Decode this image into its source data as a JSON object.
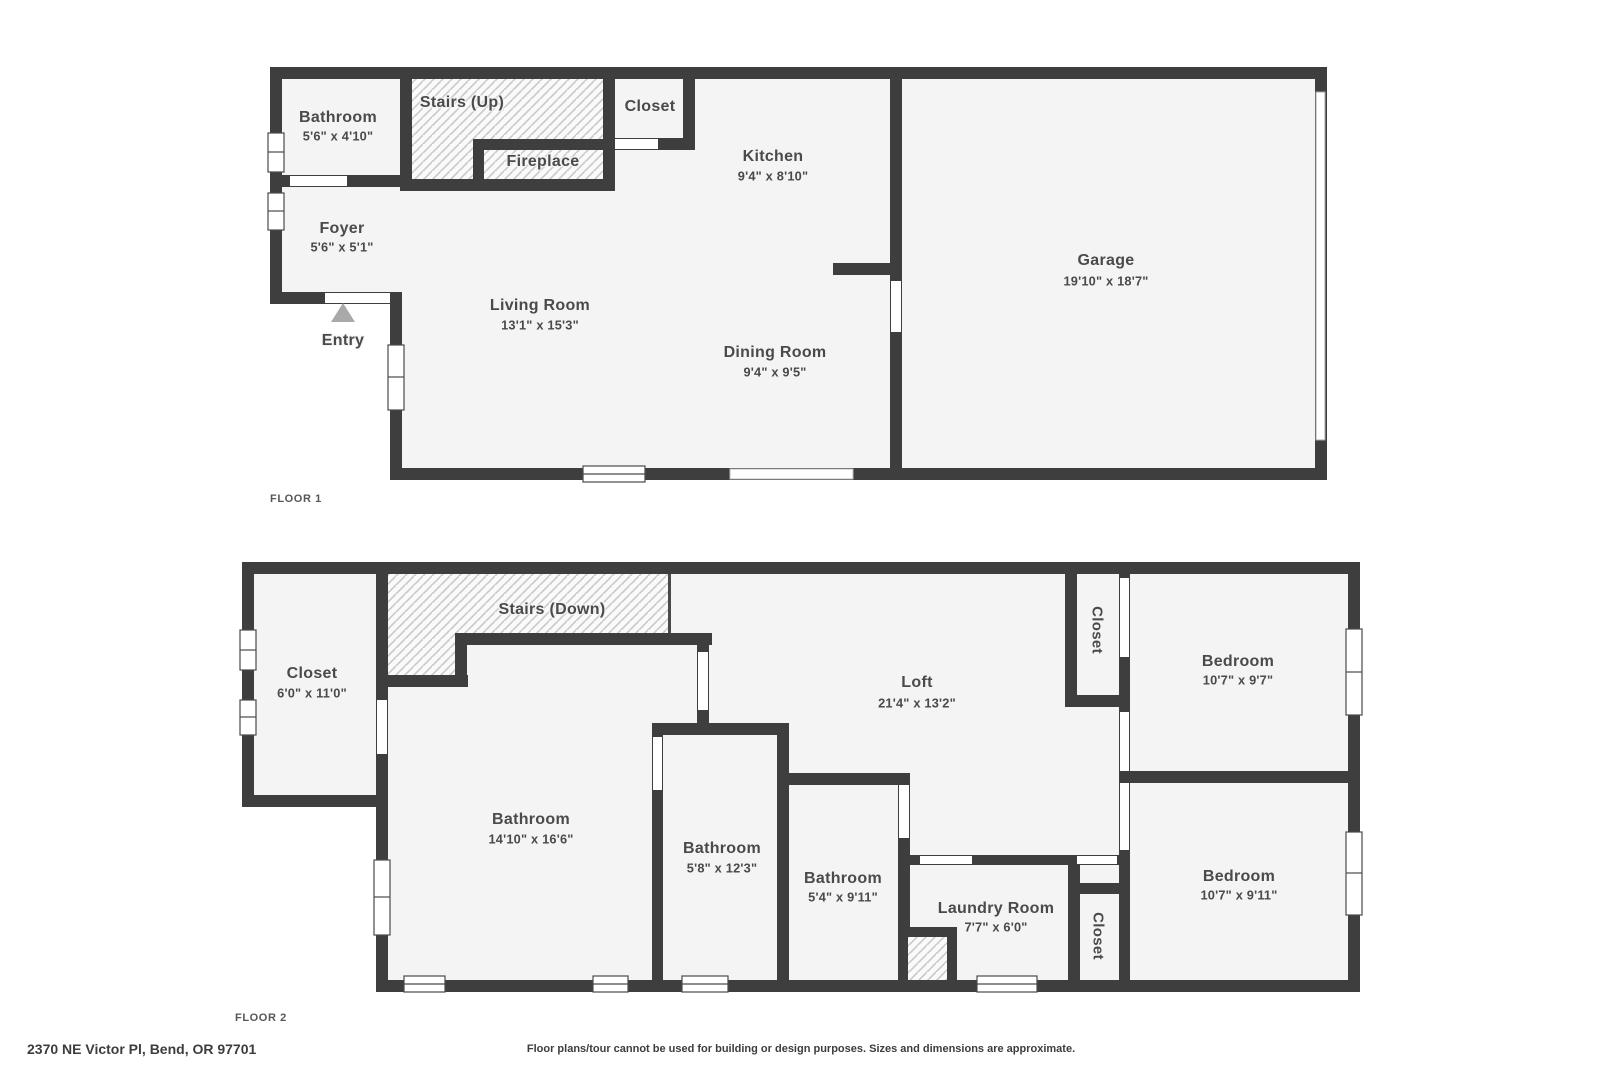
{
  "colors": {
    "wall": "#3e3e3e",
    "floor": "#f4f4f4",
    "hatch_fill": "#fafafa",
    "hatch_line": "#c9c9c9",
    "label": "#4a4a4a",
    "floor_tag": "#575757",
    "entry_arrow": "#a9a9a9",
    "door": "#ffffff",
    "window_frame": "#4a4a4a"
  },
  "floor1": {
    "label": "FLOOR 1",
    "rooms": {
      "bathroom": {
        "name": "Bathroom",
        "dims": "5'6\" x 4'10\""
      },
      "stairs_up": {
        "name": "Stairs (Up)"
      },
      "closet": {
        "name": "Closet"
      },
      "kitchen": {
        "name": "Kitchen",
        "dims": "9'4\" x 8'10\""
      },
      "fireplace": {
        "name": "Fireplace"
      },
      "foyer": {
        "name": "Foyer",
        "dims": "5'6\" x 5'1\""
      },
      "garage": {
        "name": "Garage",
        "dims": "19'10\" x 18'7\""
      },
      "living_room": {
        "name": "Living Room",
        "dims": "13'1\" x 15'3\""
      },
      "entry": {
        "name": "Entry"
      },
      "dining_room": {
        "name": "Dining Room",
        "dims": "9'4\" x 9'5\""
      }
    }
  },
  "floor2": {
    "label": "FLOOR 2",
    "rooms": {
      "closet_room": {
        "name": "Closet",
        "dims": "6'0\" x 11'0\""
      },
      "stairs_down": {
        "name": "Stairs (Down)"
      },
      "bathroom_large": {
        "name": "Bathroom",
        "dims": "14'10\" x 16'6\""
      },
      "bathroom_mid": {
        "name": "Bathroom",
        "dims": "5'8\" x 12'3\""
      },
      "bathroom_small": {
        "name": "Bathroom",
        "dims": "5'4\" x 9'11\""
      },
      "laundry": {
        "name": "Laundry Room",
        "dims": "7'7\" x 6'0\""
      },
      "loft": {
        "name": "Loft",
        "dims": "21'4\" x 13'2\""
      },
      "closet_top": {
        "name": "Closet"
      },
      "closet_bottom": {
        "name": "Closet"
      },
      "bedroom_top": {
        "name": "Bedroom",
        "dims": "10'7\" x 9'7\""
      },
      "bedroom_bottom": {
        "name": "Bedroom",
        "dims": "10'7\" x 9'11\""
      }
    }
  },
  "footer": {
    "address": "2370 NE Victor Pl, Bend, OR 97701",
    "disclaimer": "Floor plans/tour cannot be used for building or design purposes. Sizes and dimensions are approximate."
  }
}
